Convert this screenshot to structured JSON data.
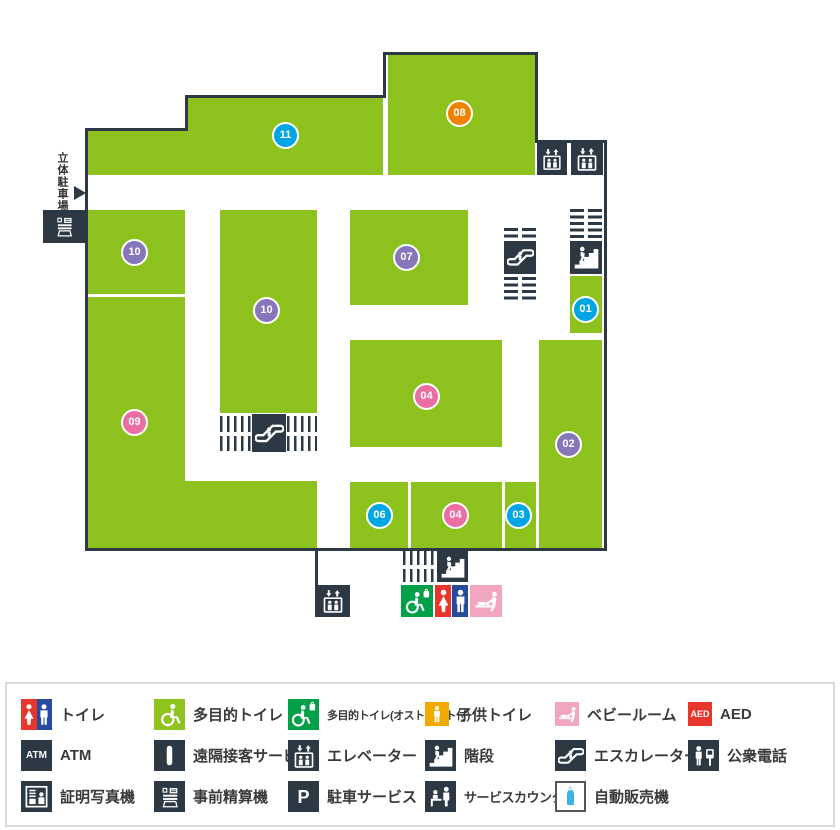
{
  "map": {
    "parking_label": "立体駐車場",
    "areas": [
      {
        "number": "11",
        "color": "#00a6e4"
      },
      {
        "number": "08",
        "color": "#ef8200"
      },
      {
        "number": "10",
        "color": "#8577b9"
      },
      {
        "number": "09",
        "color": "#ea6da4"
      },
      {
        "number": "10",
        "color": "#8577b9"
      },
      {
        "number": "07",
        "color": "#8577b9"
      },
      {
        "number": "04",
        "color": "#ea6da4"
      },
      {
        "number": "06",
        "color": "#00a6e4"
      },
      {
        "number": "04",
        "color": "#ea6da4"
      },
      {
        "number": "03",
        "color": "#00a6e4"
      },
      {
        "number": "02",
        "color": "#8577b9"
      },
      {
        "number": "01",
        "color": "#00a6e4"
      }
    ]
  },
  "legend": {
    "items": [
      {
        "icon": "toilet",
        "label": "トイレ"
      },
      {
        "icon": "accessible-toilet",
        "label": "多目的トイレ"
      },
      {
        "icon": "accessible-toilet-ostomate",
        "label": "多目的トイレ(オストメイト付)"
      },
      {
        "icon": "kids-toilet",
        "label": "子供トイレ"
      },
      {
        "icon": "baby-room",
        "label": "ベビールーム"
      },
      {
        "icon": "aed",
        "label": "AED",
        "glyph_text": "AED"
      },
      {
        "icon": "atm",
        "label": "ATM",
        "glyph_text": "ATM"
      },
      {
        "icon": "remote-service",
        "label": "遠隔接客サービス"
      },
      {
        "icon": "elevator",
        "label": "エレベーター"
      },
      {
        "icon": "stairs",
        "label": "階段"
      },
      {
        "icon": "escalator",
        "label": "エスカレーター"
      },
      {
        "icon": "public-phone",
        "label": "公衆電話"
      },
      {
        "icon": "photo-booth",
        "label": "証明写真機"
      },
      {
        "icon": "payment-machine",
        "label": "事前精算機"
      },
      {
        "icon": "parking-service",
        "label": "駐車サービス",
        "glyph_text": "P"
      },
      {
        "icon": "service-counter",
        "label": "サービスカウンター"
      },
      {
        "icon": "vending-machine",
        "label": "自動販売機"
      }
    ]
  },
  "colors": {
    "area_green": "#8dc21e",
    "wall_dark": "#2c3944",
    "badge_blue": "#00a6e4",
    "badge_purple": "#8577b9",
    "badge_pink": "#ea6da4",
    "badge_orange": "#ef8200",
    "toilet_red": "#e7372d",
    "toilet_blue": "#274a9d",
    "multipurpose_green": "#8fc31e",
    "ostomate_green": "#00a048",
    "kids_orange": "#f2a900",
    "baby_pink": "#f2a5c1",
    "aed_red": "#e7372d",
    "bottle_blue": "#3fb0e0"
  }
}
